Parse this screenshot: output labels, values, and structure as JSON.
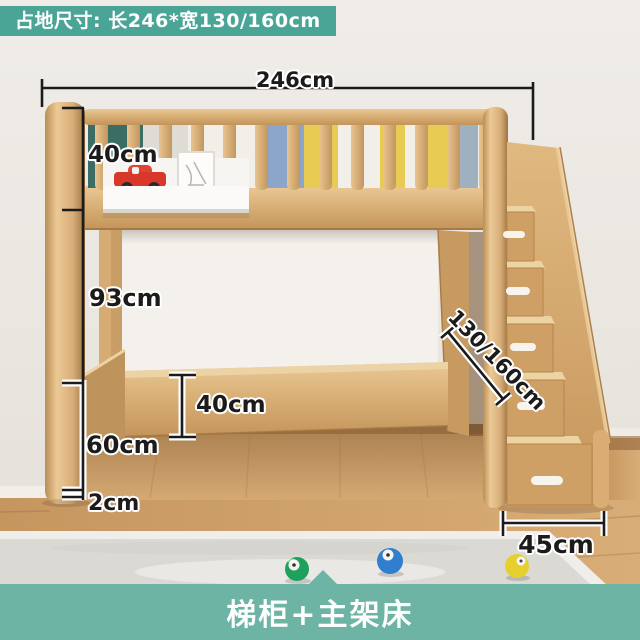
{
  "header": {
    "text": "占地尺寸: 长246*宽130/160cm"
  },
  "footer": {
    "text": "梯柜+主架床"
  },
  "dimensions": {
    "total_length": "246cm",
    "guardrail_height": "40cm",
    "clearance_height": "93cm",
    "leg_clearance": "60cm",
    "floor_gap": "2cm",
    "side_rail_height": "40cm",
    "bed_width": "130/160cm",
    "stair_depth": "45cm"
  },
  "colors": {
    "header_bg": "#4aa596",
    "footer_bg": "#6db4a4",
    "dimension_line": "#1b1b1b",
    "wood": "#d7ad78",
    "wall": "#ece9e4",
    "floor": "#c9995f"
  }
}
